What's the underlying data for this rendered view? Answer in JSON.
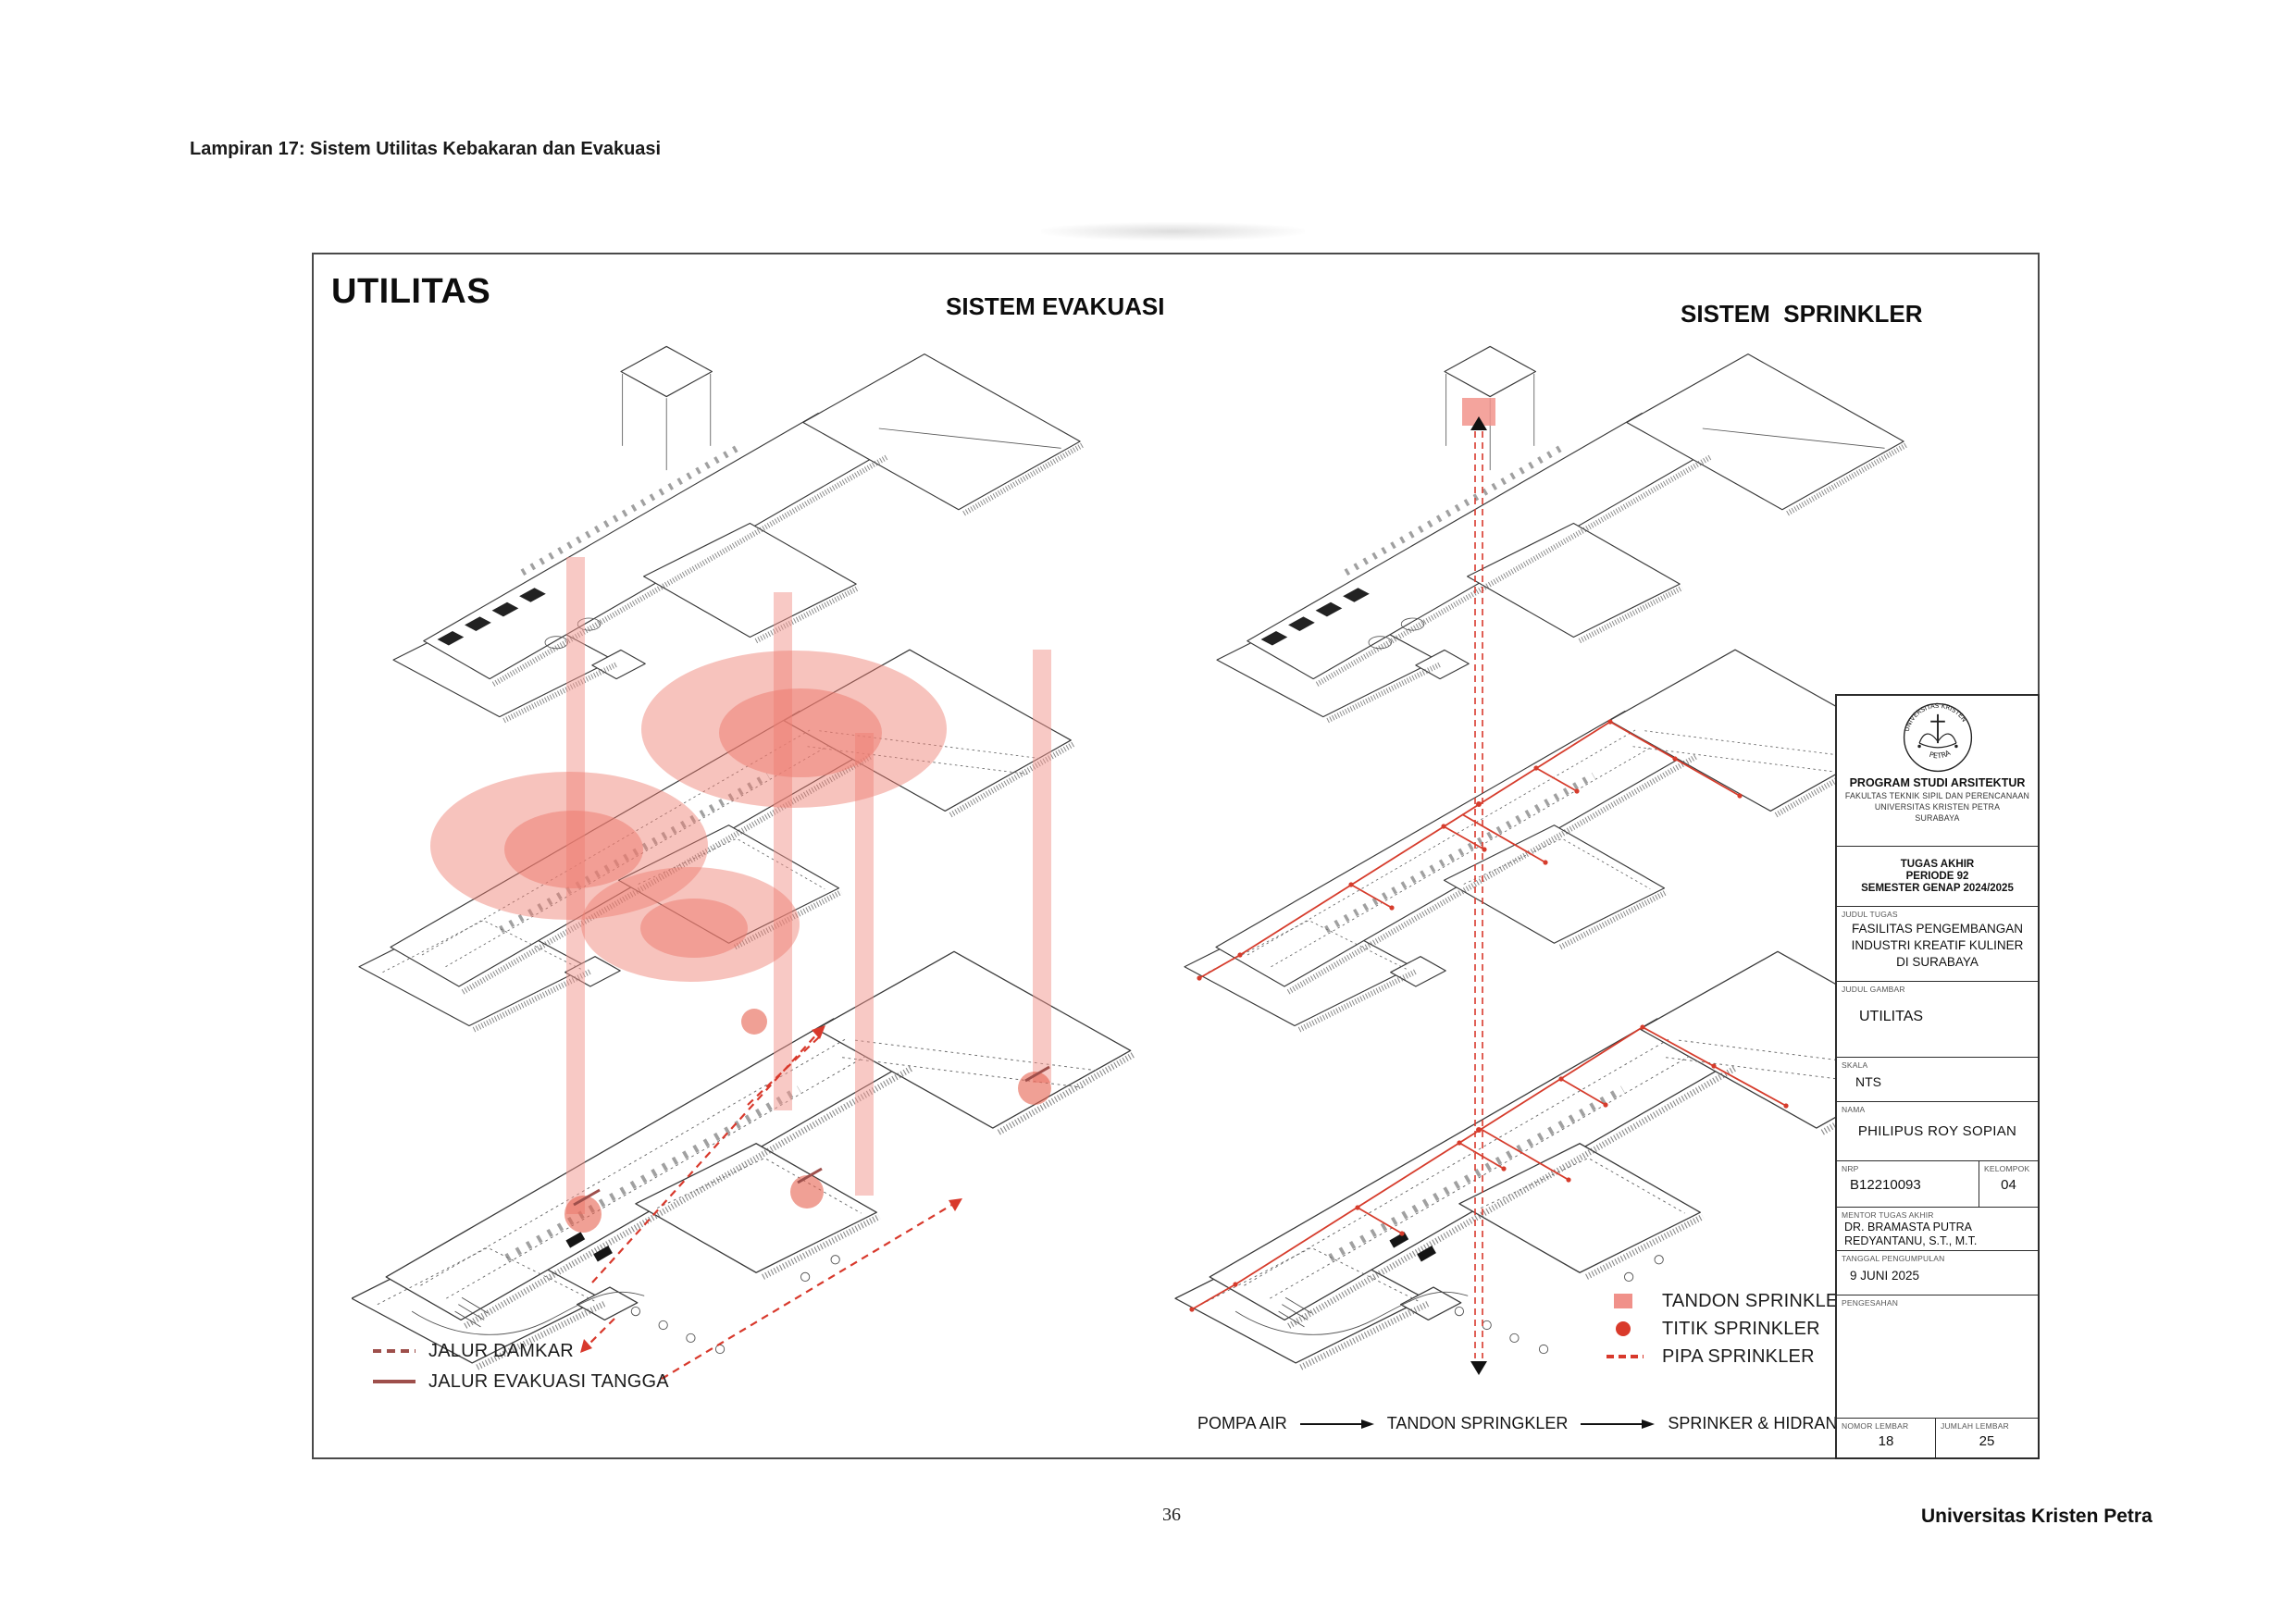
{
  "page": {
    "appendix_title": "Lampiran 17: Sistem Utilitas Kebakaran dan Evakuasi",
    "page_number": "36",
    "footer_brand": "Universitas Kristen Petra"
  },
  "sheet": {
    "title": "UTILITAS",
    "diagrams": {
      "evakuasi": {
        "heading": "SISTEM EVAKUASI",
        "legend": [
          {
            "swatch": "dashed-dark-red-line",
            "label": "JALUR DAMKAR"
          },
          {
            "swatch": "solid-dark-red-line",
            "label": "JALUR EVAKUASI TANGGA"
          }
        ]
      },
      "sprinkler": {
        "heading": "SISTEM  SPRINKLER",
        "legend": [
          {
            "swatch": "salmon-square",
            "label": "TANDON SPRINKLER"
          },
          {
            "swatch": "red-dot",
            "label": "TITIK SPRINKLER"
          },
          {
            "swatch": "dashed-red-line",
            "label": "PIPA SPRINKLER"
          }
        ]
      }
    },
    "flow": {
      "steps": [
        "POMPA AIR",
        "TANDON SPRINGKLER",
        "SPRINKER & HIDRAN KEBAKARAN"
      ]
    },
    "colors": {
      "shaft_band_salmon": "#f2948c",
      "coverage_blob_red": "#ee7a6d",
      "pipe_red": "#d63c2c",
      "route_dashed_red": "#d8392c",
      "legend_dark_red": "#9e4f4b",
      "legend_square_salmon": "#f0918a",
      "legend_dot_red": "#d93a2b",
      "linework_gray": "#3a3a3a"
    }
  },
  "titleblock": {
    "institution": {
      "logo": "universitas-kristen-petra-seal",
      "seal_top": "UNIVERSITAS KRISTEN",
      "seal_bottom": "PETRA",
      "program": "PROGRAM STUDI ARSITEKTUR",
      "faculty": "FAKULTAS TEKNIK SIPIL DAN PERENCANAAN",
      "university": "UNIVERSITAS KRISTEN PETRA",
      "city": "SURABAYA"
    },
    "project": {
      "line1": "TUGAS AKHIR",
      "line2": "PERIODE 92",
      "line3": "SEMESTER GENAP 2024/2025"
    },
    "fields": {
      "judul_tugas": {
        "label": "JUDUL TUGAS",
        "value_lines": [
          "FASILITAS PENGEMBANGAN",
          "INDUSTRI KREATIF KULINER",
          "DI SURABAYA"
        ]
      },
      "judul_gambar": {
        "label": "JUDUL GAMBAR",
        "value": "UTILITAS"
      },
      "skala": {
        "label": "SKALA",
        "value": "NTS"
      },
      "nama": {
        "label": "NAMA",
        "value": "PHILIPUS ROY SOPIAN"
      },
      "nrp": {
        "label": "NRP",
        "value": "B12210093"
      },
      "kelompok": {
        "label": "KELOMPOK",
        "value": "04"
      },
      "mentor": {
        "label": "MENTOR TUGAS AKHIR",
        "value_lines": [
          "DR. BRAMASTA PUTRA",
          "REDYANTANU, S.T., M.T."
        ]
      },
      "tanggal": {
        "label": "TANGGAL PENGUMPULAN",
        "value": "9 JUNI 2025"
      },
      "pengesahan": {
        "label": "PENGESAHAN"
      },
      "nomor_lembar": {
        "label": "NOMOR LEMBAR",
        "value": "18"
      },
      "jumlah_lembar": {
        "label": "JUMLAH LEMBAR",
        "value": "25"
      }
    }
  }
}
